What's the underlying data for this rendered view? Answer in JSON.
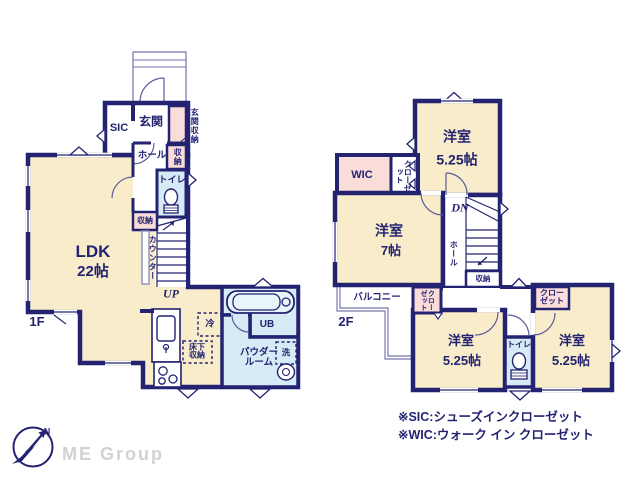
{
  "colors": {
    "wall_navy": "#232372",
    "room_cream": "#f8ecca",
    "closet_pink": "#fadcd9",
    "wet_area_blue": "#d6ebf6",
    "thin_line": "#8d8dbb",
    "logo_gray": "#d2d2d2"
  },
  "floor1": {
    "floor_label": "1F",
    "ldk": {
      "name": "LDK",
      "size": "22帖"
    },
    "entrance": "玄関",
    "sic": "SIC",
    "entrance_storage": "玄関収納",
    "hall": "ホール",
    "storage_upper": "収納",
    "toilet": "トイレ",
    "storage_lower": "収納",
    "counter": "カウンター",
    "stairs_up": "UP",
    "fridge": "冷",
    "underfloor_storage": "床下収納",
    "powder_room": "パウダールーム",
    "unit_bath": "UB",
    "washer": "洗"
  },
  "floor2": {
    "floor_label": "2F",
    "room_top": {
      "name": "洋室",
      "size": "5.25帖"
    },
    "wic": "WIC",
    "closet_a": "クローゼット",
    "room_west": {
      "name": "洋室",
      "size": "7帖"
    },
    "stairs_down": "DN",
    "hall": "ホール",
    "storage": "収納",
    "balcony": "バルコニー",
    "closet_b": "クローゼット",
    "room_middle": {
      "name": "洋室",
      "size": "5.25帖"
    },
    "toilet": "トイレ",
    "closet_c": "クローゼット",
    "room_east": {
      "name": "洋室",
      "size": "5.25帖"
    }
  },
  "notes": {
    "sic_note": "※SIC:シューズインクローゼット",
    "wic_note": "※WIC:ウォーク イン クローゼット"
  },
  "logo": {
    "company": "ME Group",
    "compass_n": "N"
  }
}
